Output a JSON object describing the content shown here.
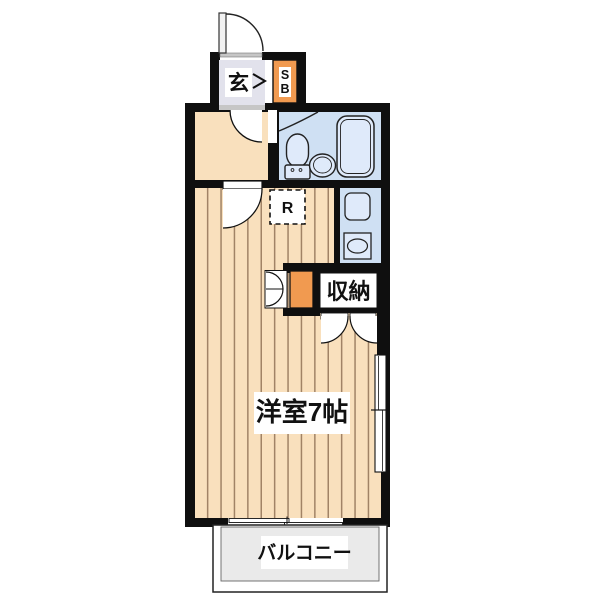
{
  "plan": {
    "labels": {
      "genkan": "玄",
      "shoebox_s": "S",
      "shoebox_b": "B",
      "refrigerator": "R",
      "closet": "収納",
      "main_room": "洋室7帖",
      "balcony": "バルコニー"
    },
    "colors": {
      "wall": "#0f0f0f",
      "wood_floor": "#f9e0bd",
      "wood_stripe": "#a18366",
      "genkan_floor": "#e2e2ec",
      "water_area": "#cfe0f3",
      "fixture": "#dfeafa",
      "accent_orange": "#f19a50",
      "balcony_floor": "#eaeaea",
      "sill_gray": "#c6c6c6"
    }
  }
}
